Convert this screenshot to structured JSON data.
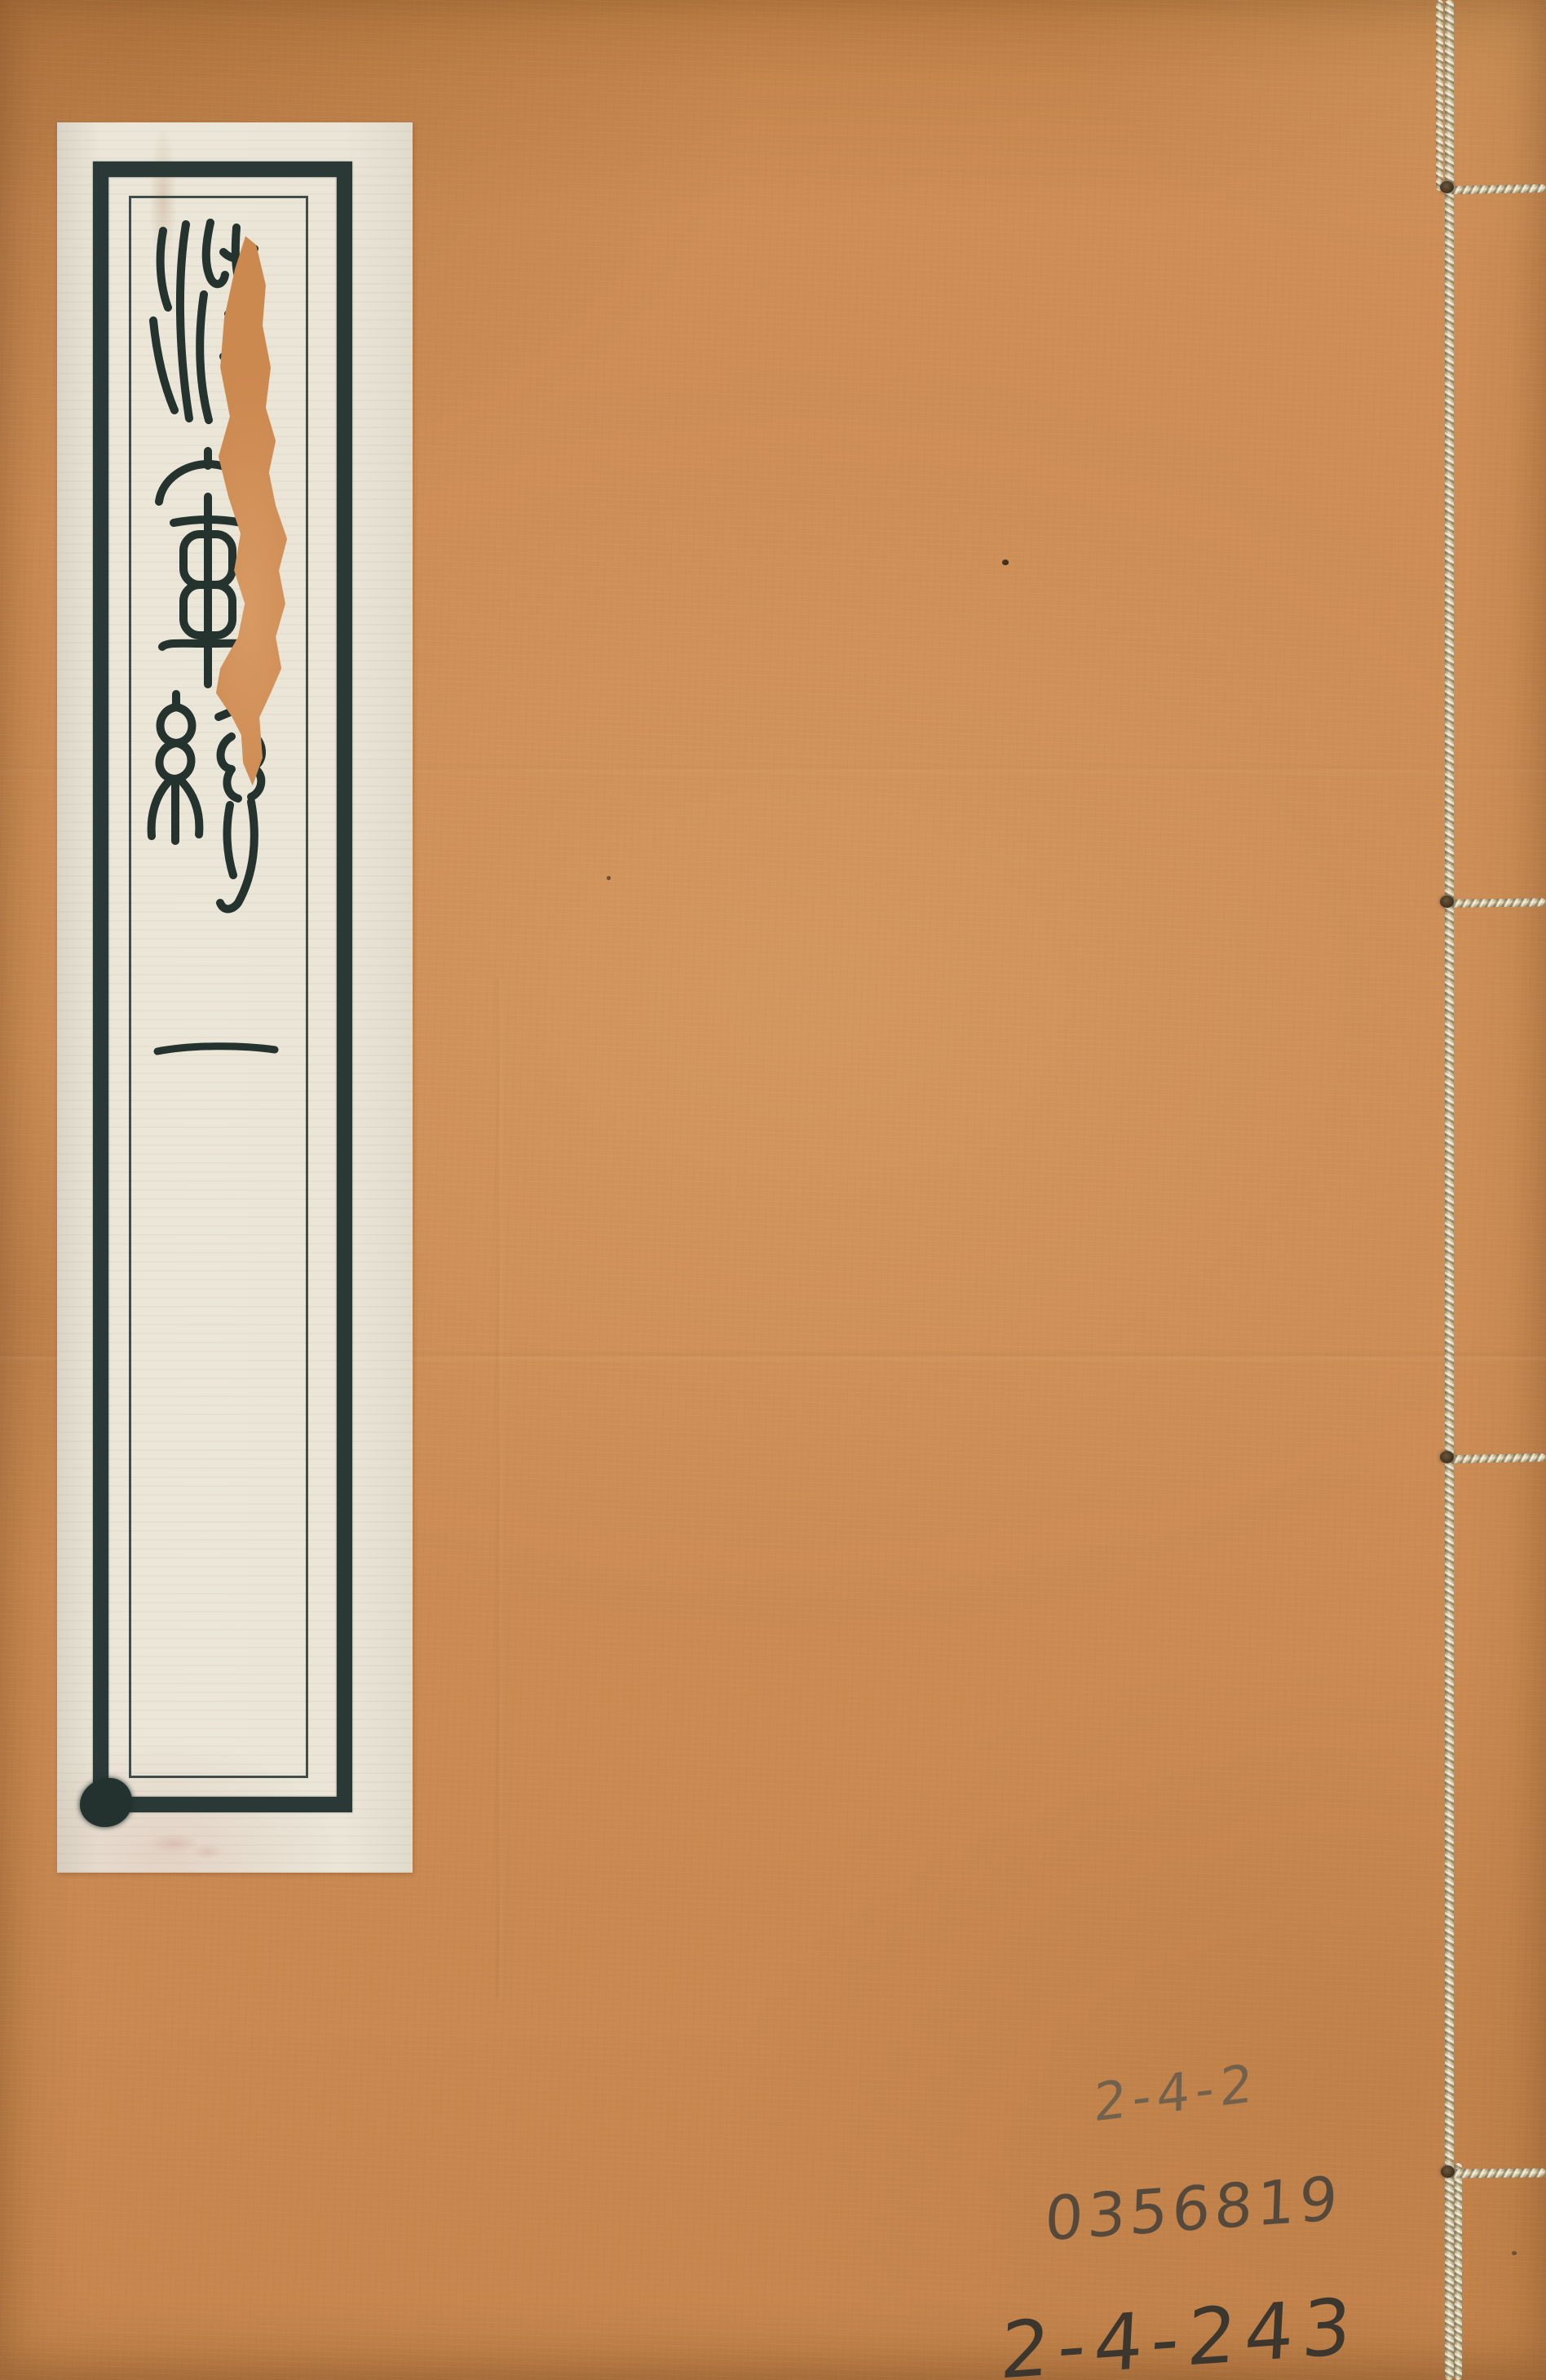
{
  "artifact": {
    "kind": "Front cover of a traditional thread-bound book (scanned)",
    "cover_color": "#cc8c54",
    "label_paper_color": "#eae5d7",
    "frame_ink_color": "#2b3936",
    "title_ink_color": "#24332e",
    "thread_color": "#e9ddb8",
    "tear_fill_color": "#d0905a",
    "pencil_color": "#49433a"
  },
  "title_label": {
    "script_style": "seal script, read top to bottom",
    "characters": [
      {
        "glyph": "海",
        "note": "partially lost to vertical tear in label"
      },
      {
        "glyph": "軍"
      },
      {
        "glyph": "統"
      }
    ],
    "volume_marker": "一"
  },
  "handwritten_annotations": {
    "line1": "2-4-2",
    "line2": "0356819",
    "line3": "2-4-243"
  },
  "binding": {
    "style": "four-hole stitched binding, thread along right edge",
    "junction_count": 4
  }
}
